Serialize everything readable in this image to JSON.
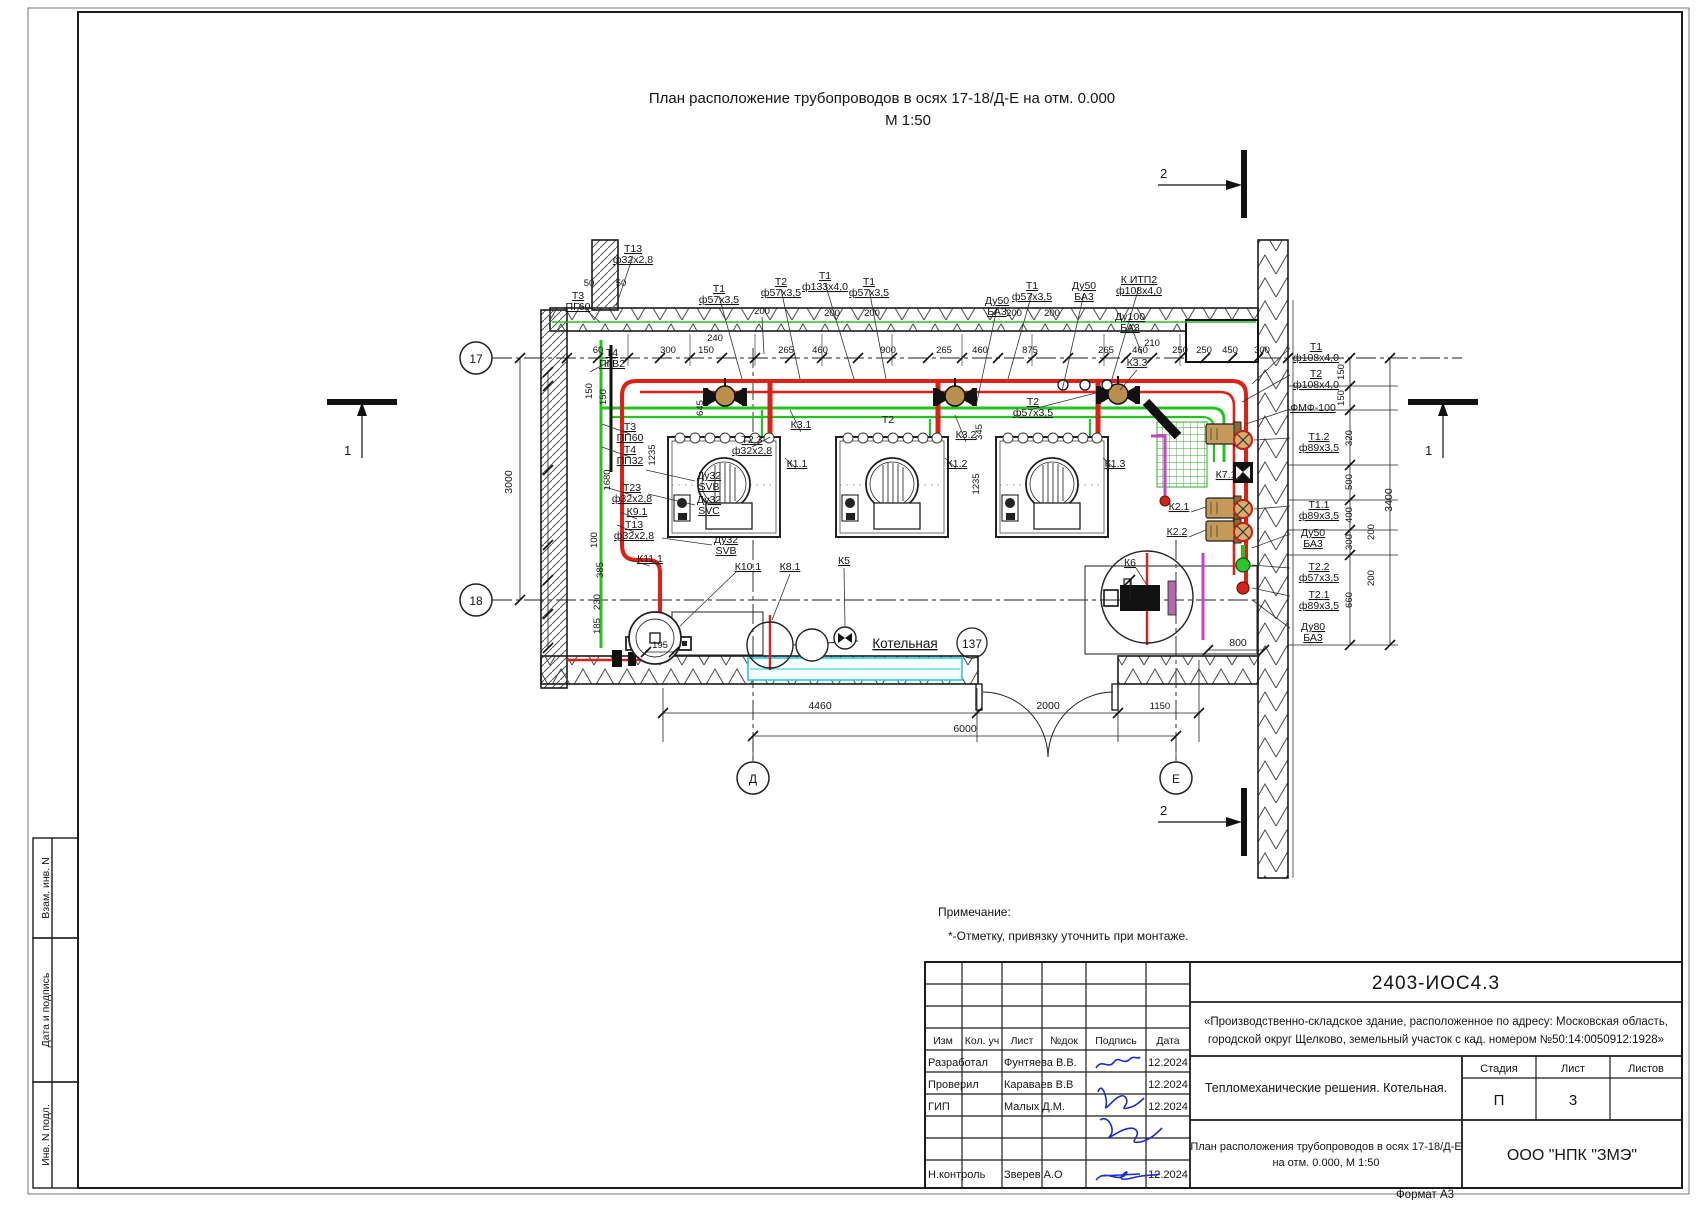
{
  "page": {
    "format": "Формат А3"
  },
  "title": {
    "line1": "План расположение трубопроводов в осях 17-18/Д-Е на отм. 0.000",
    "line2": "М 1:50"
  },
  "note": {
    "head": "Примечание:",
    "body": "*-Отметку, привязку уточнить при монтаже."
  },
  "side_stamp": {
    "box1": "Взам. инв. N",
    "box2": "Дата и подпись",
    "box3": "Инв. N подл."
  },
  "titleblock": {
    "doc": "2403-ИОС4.3",
    "desc1": "«Производственно-складское здание, расположенное по адресу: Московская область,",
    "desc2": "городской округ Щелково, земельный участок с кад. номером №50:14:0050912:1928»",
    "cols": {
      "izm": "Изм",
      "kol": "Кол. уч",
      "list": "Лист",
      "doc": "№док",
      "sign": "Подпись",
      "date": "Дата"
    },
    "rows": [
      {
        "role": "Разработал",
        "name": "Фунтяева В.В.",
        "date": "12.2024"
      },
      {
        "role": "Проверил",
        "name": "Караваев В.В",
        "date": "12.2024"
      },
      {
        "role": "ГИП",
        "name": "Малых Д.М.",
        "date": "12.2024"
      },
      {
        "role": "Н.контроль",
        "name": "Зверев А.О",
        "date": "12.2024"
      }
    ],
    "section": "Тепломеханические решения. Котельная.",
    "sheet_title1": "План расположения трубопроводов в осях 17-18/Д-Е",
    "sheet_title2": "на отм. 0.000, М 1:50",
    "stage_h": "Стадия",
    "list_h": "Лист",
    "listov_h": "Листов",
    "stage": "П",
    "list": "3",
    "company": "ООО \"НПК \"ЗМЭ\""
  },
  "drawing": {
    "room_name": "Котельная",
    "room_no": "137",
    "axes": {
      "a17": "17",
      "a18": "18",
      "ad": "Д",
      "ae": "Е"
    },
    "sections": {
      "top": "2",
      "bottom": "2",
      "left": "1",
      "right": "1"
    },
    "colors": {
      "supply": "#e02015",
      "return": "#22c41e",
      "drain": "#cc3ecc",
      "window": "#29c8d8",
      "tan": "#c49a5a"
    },
    "ann": [
      {
        "x": 633,
        "y": 252,
        "u": 1,
        "l": [
          "Т13",
          "ф32х2,8"
        ]
      },
      {
        "x": 589,
        "y": 286,
        "l": [
          "50"
        ],
        "s": 9.5
      },
      {
        "x": 621,
        "y": 286,
        "l": [
          "50"
        ],
        "s": 9.5
      },
      {
        "x": 578,
        "y": 299,
        "u": 1,
        "l": [
          "Т3",
          "ПГ60"
        ]
      },
      {
        "x": 719,
        "y": 292,
        "u": 1,
        "l": [
          "Т1",
          "ф57х3,5"
        ]
      },
      {
        "x": 762,
        "y": 314,
        "l": [
          "200"
        ],
        "s": 9.5
      },
      {
        "x": 781,
        "y": 285,
        "u": 1,
        "l": [
          "Т2",
          "ф57х3,5"
        ]
      },
      {
        "x": 825,
        "y": 279,
        "u": 1,
        "l": [
          "Т1",
          "ф133х4,0"
        ]
      },
      {
        "x": 869,
        "y": 285,
        "u": 1,
        "l": [
          "Т1",
          "ф57х3,5"
        ]
      },
      {
        "x": 832,
        "y": 316,
        "l": [
          "200"
        ],
        "s": 9.5
      },
      {
        "x": 872,
        "y": 316,
        "l": [
          "200"
        ],
        "s": 9.5
      },
      {
        "x": 997,
        "y": 304,
        "u": 1,
        "l": [
          "Ду50",
          "БА3"
        ]
      },
      {
        "x": 1032,
        "y": 289,
        "u": 1,
        "l": [
          "Т1",
          "ф57х3,5"
        ]
      },
      {
        "x": 1084,
        "y": 289,
        "u": 1,
        "l": [
          "Ду50",
          "БА3"
        ]
      },
      {
        "x": 1139,
        "y": 283,
        "u": 1,
        "l": [
          "К ИТП2",
          "ф108х4,0"
        ]
      },
      {
        "x": 1130,
        "y": 320,
        "u": 1,
        "l": [
          "Ду100",
          "БА3"
        ]
      },
      {
        "x": 1014,
        "y": 316,
        "l": [
          "200"
        ],
        "s": 9.5
      },
      {
        "x": 1052,
        "y": 316,
        "l": [
          "200"
        ],
        "s": 9.5
      },
      {
        "x": 1152,
        "y": 346,
        "l": [
          "210"
        ],
        "s": 9.5
      },
      {
        "x": 715,
        "y": 341,
        "l": [
          "240"
        ],
        "s": 9.5
      },
      {
        "x": 1137,
        "y": 366,
        "u": 1,
        "l": [
          "К3.3"
        ]
      },
      {
        "x": 598,
        "y": 353,
        "l": [
          "60"
        ],
        "s": 9.5
      },
      {
        "x": 668,
        "y": 353,
        "l": [
          "300"
        ],
        "s": 9.5
      },
      {
        "x": 706,
        "y": 353,
        "l": [
          "150"
        ],
        "s": 9.5
      },
      {
        "x": 786,
        "y": 353,
        "l": [
          "265"
        ],
        "s": 9.5
      },
      {
        "x": 820,
        "y": 353,
        "l": [
          "460"
        ],
        "s": 9.5
      },
      {
        "x": 888,
        "y": 353,
        "l": [
          "900"
        ],
        "s": 9.5
      },
      {
        "x": 944,
        "y": 353,
        "l": [
          "265"
        ],
        "s": 9.5
      },
      {
        "x": 980,
        "y": 353,
        "l": [
          "460"
        ],
        "s": 9.5
      },
      {
        "x": 1030,
        "y": 353,
        "l": [
          "875"
        ],
        "s": 9.5
      },
      {
        "x": 1106,
        "y": 353,
        "l": [
          "265"
        ],
        "s": 9.5
      },
      {
        "x": 1140,
        "y": 353,
        "l": [
          "460"
        ],
        "s": 9.5
      },
      {
        "x": 1180,
        "y": 353,
        "l": [
          "250"
        ],
        "s": 9.5
      },
      {
        "x": 1204,
        "y": 353,
        "l": [
          "250"
        ],
        "s": 9.5
      },
      {
        "x": 1230,
        "y": 353,
        "l": [
          "450"
        ],
        "s": 9.5
      },
      {
        "x": 1262,
        "y": 353,
        "l": [
          "300"
        ],
        "s": 9.5
      },
      {
        "x": 612,
        "y": 356,
        "u": 1,
        "l": [
          "Т4",
          "ПГВ2"
        ]
      },
      {
        "x": 592,
        "y": 391,
        "r": 1,
        "l": [
          "150"
        ],
        "s": 9.5
      },
      {
        "x": 606,
        "y": 397,
        "r": 1,
        "l": [
          "150"
        ],
        "s": 9.5
      },
      {
        "x": 630,
        "y": 430,
        "u": 1,
        "l": [
          "Т3",
          "ПП60"
        ]
      },
      {
        "x": 630,
        "y": 453,
        "u": 1,
        "l": [
          "Т4",
          "ПП32"
        ]
      },
      {
        "x": 610,
        "y": 480,
        "r": 1,
        "l": [
          "1680"
        ],
        "s": 9.5
      },
      {
        "x": 632,
        "y": 491,
        "u": 1,
        "l": [
          "Т23",
          "ф32х2,8"
        ]
      },
      {
        "x": 637,
        "y": 515,
        "u": 1,
        "l": [
          "К9.1"
        ]
      },
      {
        "x": 634,
        "y": 528,
        "u": 1,
        "l": [
          "Т13",
          "ф32х2,8"
        ]
      },
      {
        "x": 597,
        "y": 540,
        "r": 1,
        "l": [
          "100"
        ],
        "s": 9.5
      },
      {
        "x": 603,
        "y": 570,
        "r": 1,
        "l": [
          "385"
        ],
        "s": 9.5
      },
      {
        "x": 650,
        "y": 562,
        "u": 1,
        "l": [
          "К11.1"
        ]
      },
      {
        "x": 600,
        "y": 602,
        "r": 1,
        "l": [
          "230"
        ],
        "s": 9.5
      },
      {
        "x": 600,
        "y": 626,
        "r": 1,
        "l": [
          "185"
        ],
        "s": 9.5
      },
      {
        "x": 512,
        "y": 482,
        "r": 1,
        "l": [
          "3000"
        ]
      },
      {
        "x": 703,
        "y": 408,
        "r": 1,
        "l": [
          "645"
        ],
        "s": 9.5
      },
      {
        "x": 655,
        "y": 455,
        "r": 1,
        "l": [
          "1235"
        ],
        "s": 9.5
      },
      {
        "x": 709,
        "y": 479,
        "u": 1,
        "l": [
          "Ду32",
          "SVB"
        ]
      },
      {
        "x": 709,
        "y": 503,
        "u": 1,
        "l": [
          "Ду32",
          "SVC"
        ]
      },
      {
        "x": 726,
        "y": 543,
        "u": 1,
        "l": [
          "Ду32",
          "SVB"
        ]
      },
      {
        "x": 748,
        "y": 570,
        "u": 1,
        "l": [
          "К10.1"
        ]
      },
      {
        "x": 752,
        "y": 443,
        "u": 1,
        "l": [
          "Т2.3",
          "ф32х2,8"
        ]
      },
      {
        "x": 797,
        "y": 467,
        "u": 1,
        "l": [
          "К1.1"
        ]
      },
      {
        "x": 957,
        "y": 467,
        "u": 1,
        "l": [
          "К1.2"
        ]
      },
      {
        "x": 1115,
        "y": 467,
        "u": 1,
        "l": [
          "К1.3"
        ]
      },
      {
        "x": 888,
        "y": 423,
        "l": [
          "Т2"
        ]
      },
      {
        "x": 1033,
        "y": 405,
        "u": 1,
        "l": [
          "Т2",
          "ф57х3,5"
        ]
      },
      {
        "x": 982,
        "y": 432,
        "r": 1,
        "l": [
          "345"
        ],
        "s": 9.5
      },
      {
        "x": 979,
        "y": 484,
        "r": 1,
        "l": [
          "1235"
        ],
        "s": 9.5
      },
      {
        "x": 801,
        "y": 428,
        "u": 1,
        "l": [
          "К3.1"
        ]
      },
      {
        "x": 966,
        "y": 438,
        "u": 1,
        "l": [
          "К3.2"
        ]
      },
      {
        "x": 844,
        "y": 564,
        "u": 1,
        "l": [
          "К5"
        ]
      },
      {
        "x": 790,
        "y": 570,
        "u": 1,
        "l": [
          "К8.1"
        ]
      },
      {
        "x": 1316,
        "y": 350,
        "u": 1,
        "l": [
          "Т1",
          "ф108х4,0"
        ]
      },
      {
        "x": 1316,
        "y": 377,
        "u": 1,
        "l": [
          "Т2",
          "ф108х4,0"
        ]
      },
      {
        "x": 1313,
        "y": 411,
        "u": 1,
        "l": [
          "ФМФ-100"
        ]
      },
      {
        "x": 1319,
        "y": 440,
        "u": 1,
        "l": [
          "Т1.2",
          "ф89х3,5"
        ]
      },
      {
        "x": 1226,
        "y": 478,
        "u": 1,
        "l": [
          "К7.1"
        ]
      },
      {
        "x": 1179,
        "y": 510,
        "u": 1,
        "l": [
          "К2.1"
        ]
      },
      {
        "x": 1177,
        "y": 535,
        "u": 1,
        "l": [
          "К2.2"
        ]
      },
      {
        "x": 1319,
        "y": 508,
        "u": 1,
        "l": [
          "Т1.1",
          "ф89х3,5"
        ]
      },
      {
        "x": 1313,
        "y": 536,
        "u": 1,
        "l": [
          "Ду50",
          "БА3"
        ]
      },
      {
        "x": 1319,
        "y": 570,
        "u": 1,
        "l": [
          "Т2.2",
          "ф57х3,5"
        ]
      },
      {
        "x": 1319,
        "y": 598,
        "u": 1,
        "l": [
          "Т2.1",
          "ф89х3,5"
        ]
      },
      {
        "x": 1313,
        "y": 630,
        "u": 1,
        "l": [
          "Ду80",
          "БА3"
        ]
      },
      {
        "x": 1130,
        "y": 566,
        "u": 1,
        "l": [
          "К6"
        ]
      },
      {
        "x": 1344,
        "y": 372,
        "r": 1,
        "l": [
          "150"
        ],
        "s": 9.5
      },
      {
        "x": 1344,
        "y": 398,
        "r": 1,
        "l": [
          "150"
        ],
        "s": 9.5
      },
      {
        "x": 1352,
        "y": 438,
        "r": 1,
        "l": [
          "320"
        ],
        "s": 9.5
      },
      {
        "x": 1352,
        "y": 482,
        "r": 1,
        "l": [
          "500"
        ],
        "s": 9.5
      },
      {
        "x": 1352,
        "y": 515,
        "r": 1,
        "l": [
          "400"
        ],
        "s": 9.5
      },
      {
        "x": 1352,
        "y": 542,
        "r": 1,
        "l": [
          "300"
        ],
        "s": 9.5
      },
      {
        "x": 1374,
        "y": 532,
        "r": 1,
        "l": [
          "200"
        ],
        "s": 9.5
      },
      {
        "x": 1374,
        "y": 578,
        "r": 1,
        "l": [
          "200"
        ],
        "s": 9.5
      },
      {
        "x": 1352,
        "y": 600,
        "r": 1,
        "l": [
          "660"
        ],
        "s": 9.5
      },
      {
        "x": 1392,
        "y": 500,
        "r": 1,
        "l": [
          "3400"
        ]
      },
      {
        "x": 1139,
        "y": 600,
        "r": 1,
        "l": [
          "300"
        ],
        "s": 9.5
      },
      {
        "x": 1238,
        "y": 646,
        "l": [
          "800"
        ]
      },
      {
        "x": 660,
        "y": 648,
        "l": [
          "195"
        ],
        "s": 9.5
      },
      {
        "x": 820,
        "y": 709,
        "l": [
          "4460"
        ]
      },
      {
        "x": 1048,
        "y": 709,
        "l": [
          "2000"
        ]
      },
      {
        "x": 1160,
        "y": 709,
        "l": [
          "1150"
        ],
        "s": 9.5
      },
      {
        "x": 965,
        "y": 732,
        "l": [
          "6000"
        ]
      }
    ]
  }
}
